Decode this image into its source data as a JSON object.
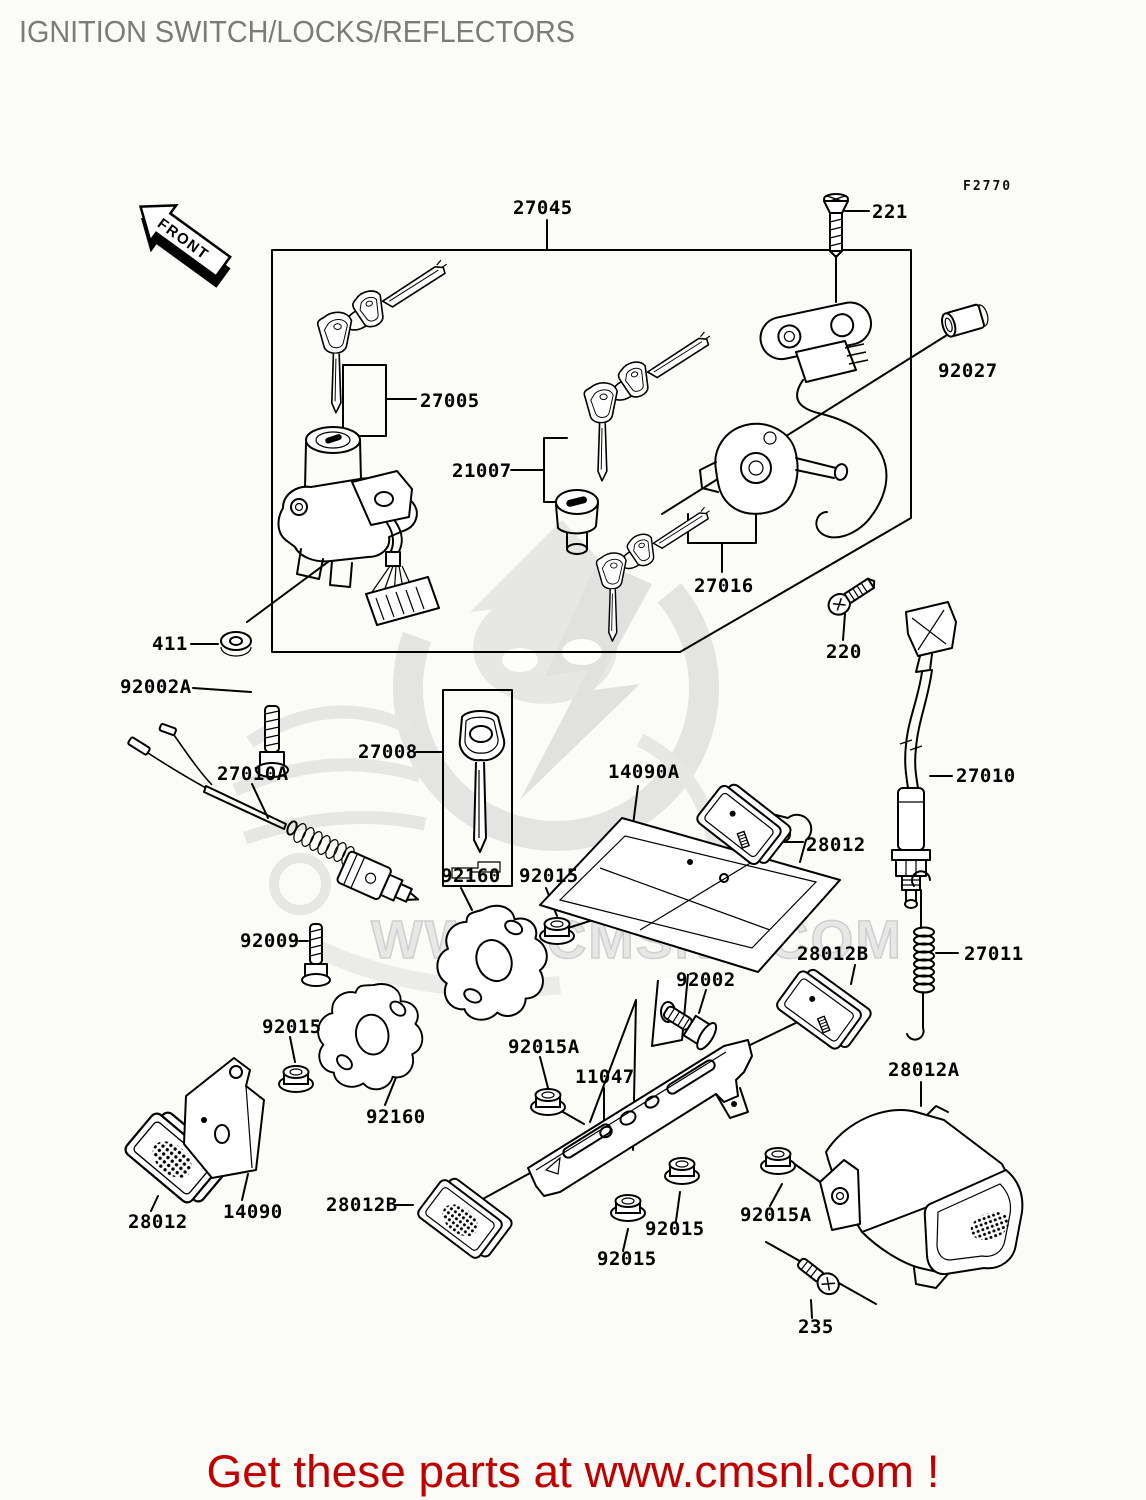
{
  "page": {
    "title": "IGNITION SWITCH/LOCKS/REFLECTORS",
    "figure_code": "F2770",
    "front_label": "FRONT",
    "watermark": "WWW.CMSNL.COM",
    "footer": "Get these parts at www.cmsnl.com !"
  },
  "colors": {
    "background": "#fbfbf7",
    "line": "#000000",
    "title_gray": "#7b7b7b",
    "footer_red": "#c00000",
    "watermark_gray": "#d8d8d8"
  },
  "parts": [
    {
      "number": "27045"
    },
    {
      "number": "221"
    },
    {
      "number": "92027"
    },
    {
      "number": "27005"
    },
    {
      "number": "21007"
    },
    {
      "number": "27016"
    },
    {
      "number": "220"
    },
    {
      "number": "411"
    },
    {
      "number": "92002A"
    },
    {
      "number": "27008"
    },
    {
      "number": "27010A"
    },
    {
      "number": "14090A"
    },
    {
      "number": "28012"
    },
    {
      "number": "27010"
    },
    {
      "number": "92160"
    },
    {
      "number": "92015"
    },
    {
      "number": "92009"
    },
    {
      "number": "27011"
    },
    {
      "number": "92002"
    },
    {
      "number": "28012B"
    },
    {
      "number": "92015A"
    },
    {
      "number": "11047"
    },
    {
      "number": "92015"
    },
    {
      "number": "92160"
    },
    {
      "number": "28012A"
    },
    {
      "number": "28012"
    },
    {
      "number": "14090"
    },
    {
      "number": "28012B"
    },
    {
      "number": "92015"
    },
    {
      "number": "92015"
    },
    {
      "number": "92015A"
    },
    {
      "number": "235"
    }
  ]
}
